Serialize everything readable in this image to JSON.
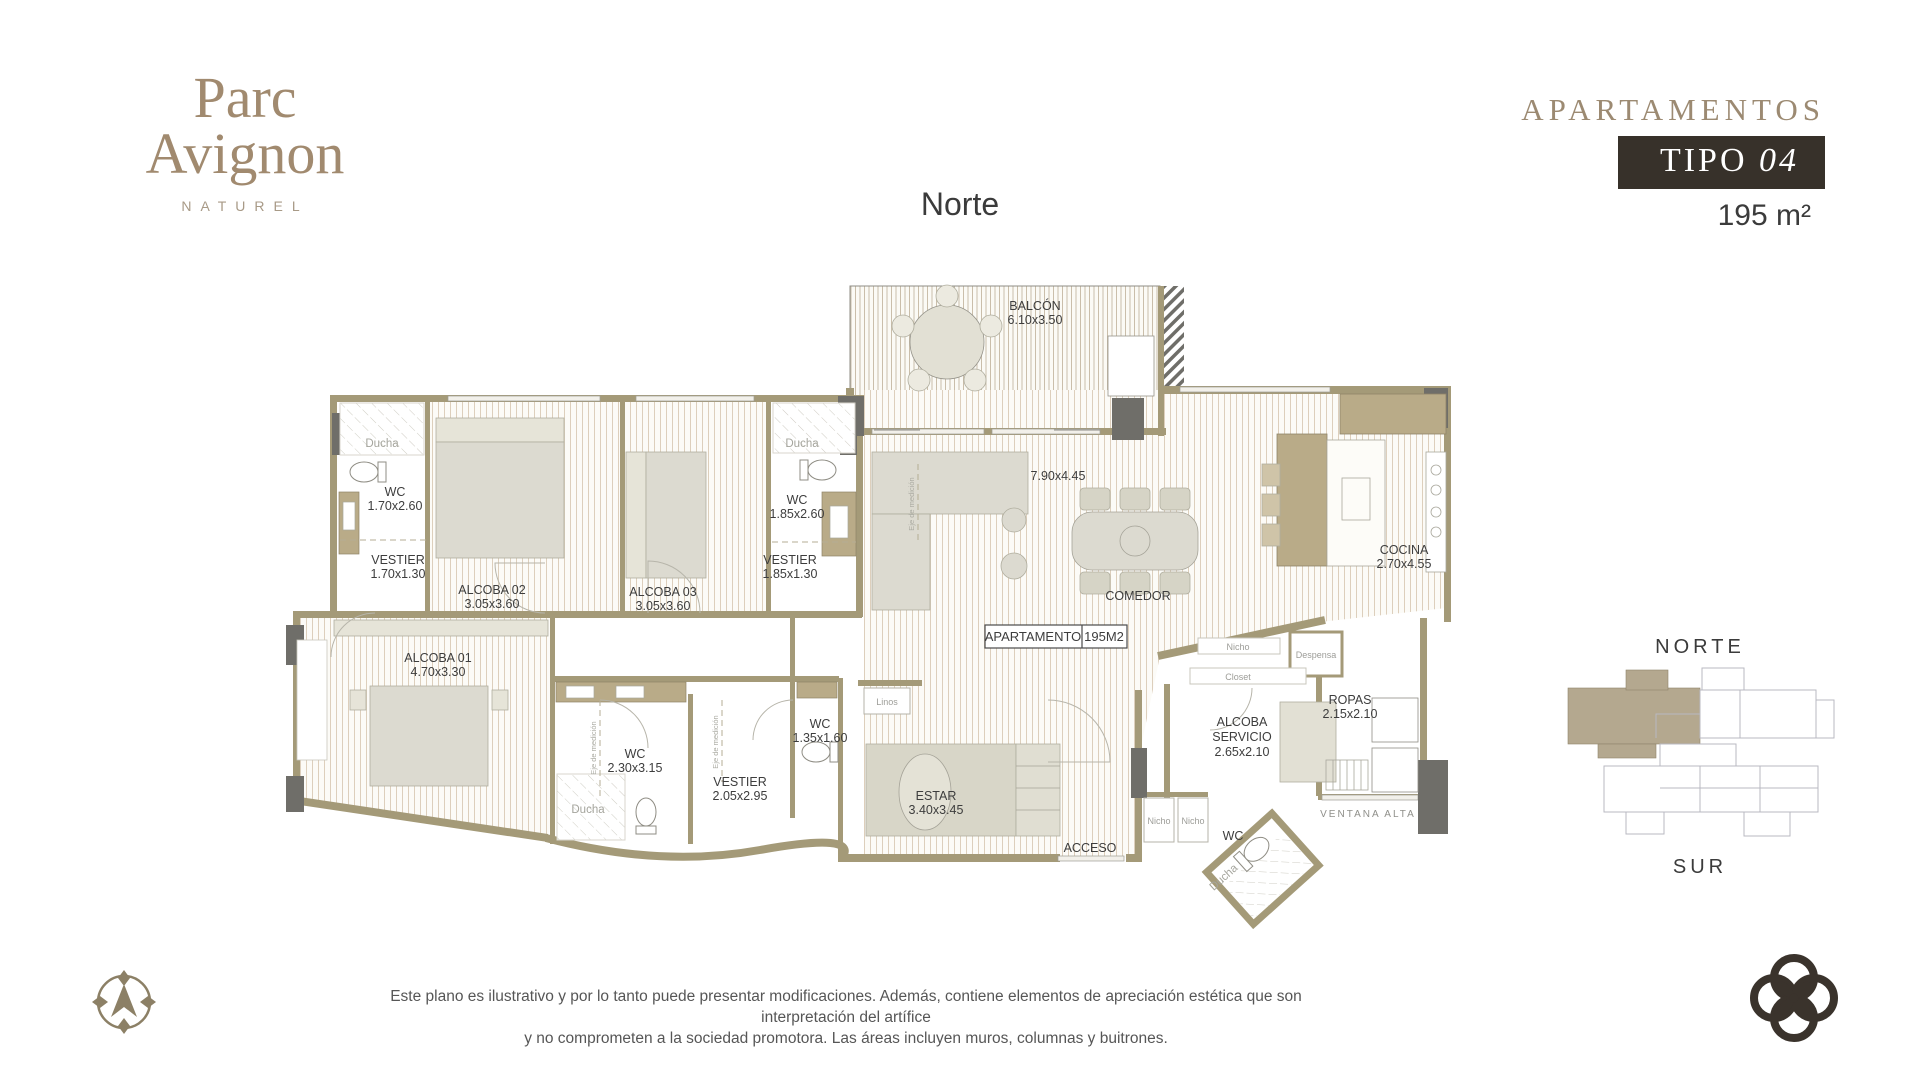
{
  "brand": {
    "line1": "Parc",
    "line2": "Avignon",
    "subtitle": "NATUREL"
  },
  "header": {
    "kicker": "APARTAMENTOS",
    "tipo": "TIPO",
    "tipo_num": "04",
    "area": "195 m²"
  },
  "plan": {
    "north_label": "Norte",
    "tag": {
      "name": "APARTAMENTO",
      "area": "195M2"
    },
    "rooms": {
      "balcon": {
        "name": "BALCÓN",
        "dims": "6.10x3.50"
      },
      "alcoba01": {
        "name": "ALCOBA 01",
        "dims": "4.70x3.30"
      },
      "alcoba02": {
        "name": "ALCOBA 02",
        "dims": "3.05x3.60"
      },
      "alcoba03": {
        "name": "ALCOBA 03",
        "dims": "3.05x3.60"
      },
      "wc_alcoba02": {
        "name": "WC",
        "dims": "1.70x2.60"
      },
      "vestier_alcoba02": {
        "name": "VESTIER",
        "dims": "1.70x1.30"
      },
      "wc_alcoba03": {
        "name": "WC",
        "dims": "1.85x2.60"
      },
      "vestier_alcoba03": {
        "name": "VESTIER",
        "dims": "1.85x1.30"
      },
      "sala": {
        "dims": "7.90x4.45"
      },
      "comedor": {
        "name": "COMEDOR"
      },
      "cocina": {
        "name": "COCINA",
        "dims": "2.70x4.55"
      },
      "wc_principal": {
        "name": "WC",
        "dims": "2.30x3.15"
      },
      "vestier_principal": {
        "name": "VESTIER",
        "dims": "2.05x2.95"
      },
      "wc_social": {
        "name": "WC",
        "dims": "1.35x1.60"
      },
      "estar": {
        "name": "ESTAR",
        "dims": "3.40x3.45"
      },
      "acceso": {
        "name": "ACCESO"
      },
      "alcoba_servicio": {
        "name1": "ALCOBA",
        "name2": "SERVICIO",
        "dims": "2.65x2.10"
      },
      "ropas": {
        "name": "ROPAS",
        "dims": "2.15x2.10"
      },
      "wc_servicio": {
        "name": "WC"
      }
    },
    "annotations": {
      "ducha": "Ducha",
      "linos": "Linos",
      "nicho": "Nicho",
      "closet": "Closet",
      "despensa": "Despensa",
      "ventana_alta": "VENTANA ALTA",
      "eje": "Eje de medición"
    }
  },
  "keyplan": {
    "north": "NORTE",
    "south": "SUR"
  },
  "disclaimer": {
    "line1": "Este plano es ilustrativo y por lo tanto puede presentar modificaciones. Además, contiene elementos de apreciación estética que son interpretación del artífice",
    "line2": "y no comprometen a la sociedad promotora. Las áreas incluyen muros, columnas y buitrones."
  },
  "colors": {
    "brand_tan": "#a18a6f",
    "dark_box": "#37312a",
    "wall": "#a49a78",
    "column": "#6f6e69",
    "counter_tan": "#b9ab88",
    "keyplan_highlight": "#b4a88f",
    "text_dark": "#3c3c3c",
    "text_gray": "#9d9d98"
  }
}
